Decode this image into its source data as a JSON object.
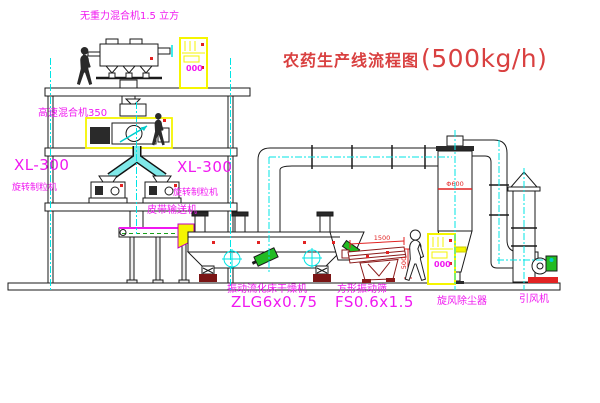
{
  "title": {
    "name": "农药生产线流程图",
    "capacity": "(500kg/h)"
  },
  "labels": {
    "gravity_mixer": "无重力混合机1.5 立方",
    "high_speed_mixer": "高速混合机350",
    "granulator_left_model": "XL-300",
    "granulator_left_name": "旋转制粒机",
    "granulator_right_model": "XL-300",
    "granulator_right_name": "旋转制粒机",
    "belt_conveyor": "皮带输送机",
    "dryer_name": "振动流化床干燥机",
    "dryer_model": "ZLG6x0.75",
    "screen_name": "方形振动筛",
    "screen_model": "FS0.6x1.5",
    "cyclone": "旋风除尘器",
    "fan": "引风机"
  },
  "dimensions": {
    "screen_width": "1500",
    "screen_height": "500",
    "cyclone_diameter": "Φ600",
    "cabinet_display_1": "000",
    "cabinet_display_2": "000"
  },
  "colors": {
    "label_magenta": "#f018f0",
    "title_red": "#d94040",
    "equipment_yellow": "#f5f500",
    "centerline_cyan": "#00e5e5",
    "motor_green": "#22bb22",
    "line_black": "#1a1a1a",
    "screen_dark_red": "#8b1a1a",
    "accent_red": "#e22222"
  }
}
